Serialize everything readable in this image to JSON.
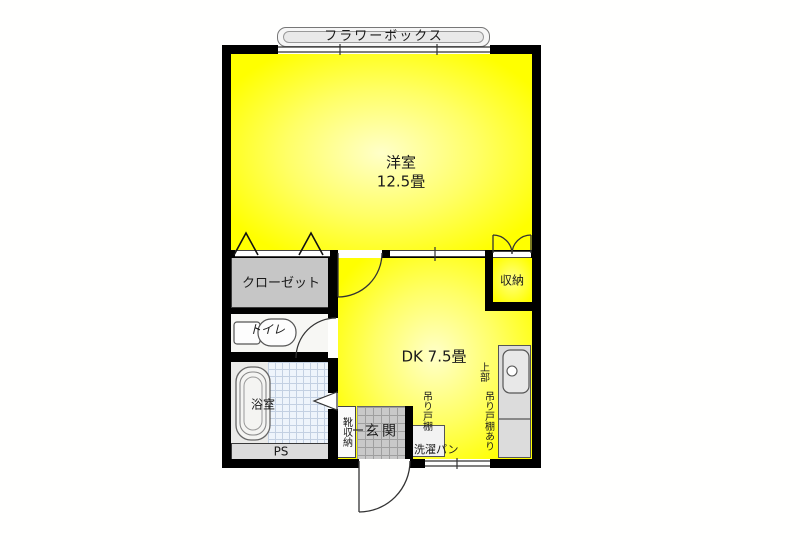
{
  "floorplan": {
    "kind": "apartment-floor-plan-1dk",
    "rooms": {
      "western_room": {
        "name": "洋室",
        "size": "12.5畳"
      },
      "dk": {
        "name": "DK 7.5畳"
      },
      "closet": {
        "name": "クローゼット"
      },
      "toilet": {
        "name": "トイレ"
      },
      "bathroom": {
        "name": "浴室"
      },
      "storage": {
        "name": "収納"
      },
      "entrance": {
        "name": "玄関"
      },
      "shoe_storage": {
        "name": "靴収納"
      },
      "pipe_space": {
        "name": "PS"
      }
    },
    "fixtures": {
      "flower_box": "フラワーボックス",
      "hanging_cupboard": "吊り戸棚",
      "washing_pan": "洗濯パン",
      "upper_note_line1": "上部",
      "upper_note_line2": "吊り戸棚あり"
    },
    "colors": {
      "room_fill": "#ffff00",
      "room_fill_center": "#ffffc9",
      "wall": "#000000",
      "closet_fill": "#c6c6c6",
      "entrance_tile": "#c9c9c9",
      "counter_fill": "#dcdcdc",
      "bath_tile": "#eef4fb",
      "background": "#fffffe"
    }
  }
}
